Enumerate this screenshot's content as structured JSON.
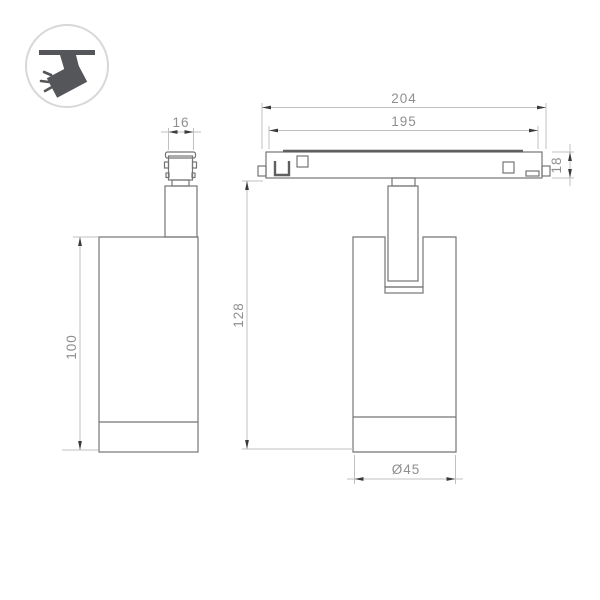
{
  "meta": {
    "description": "Technical dimension drawing of a magnetic track spotlight, side view and front view"
  },
  "icon": {
    "name": "ceiling-track-spotlight"
  },
  "dimensions": {
    "track_depth": "16",
    "track_length_overall": "204",
    "track_length_body": "195",
    "track_height": "18",
    "overall_height": "128",
    "body_height": "100",
    "body_diameter": "Ø45"
  },
  "colors": {
    "object_line": "#747474",
    "object_line_dark": "#5f5f5f",
    "dim_line": "#c0c0c0",
    "arrow": "#3a3a3a",
    "dim_text": "#8f8f8f",
    "icon_glyph": "#54565a",
    "icon_ring": "#d8d8d8"
  }
}
